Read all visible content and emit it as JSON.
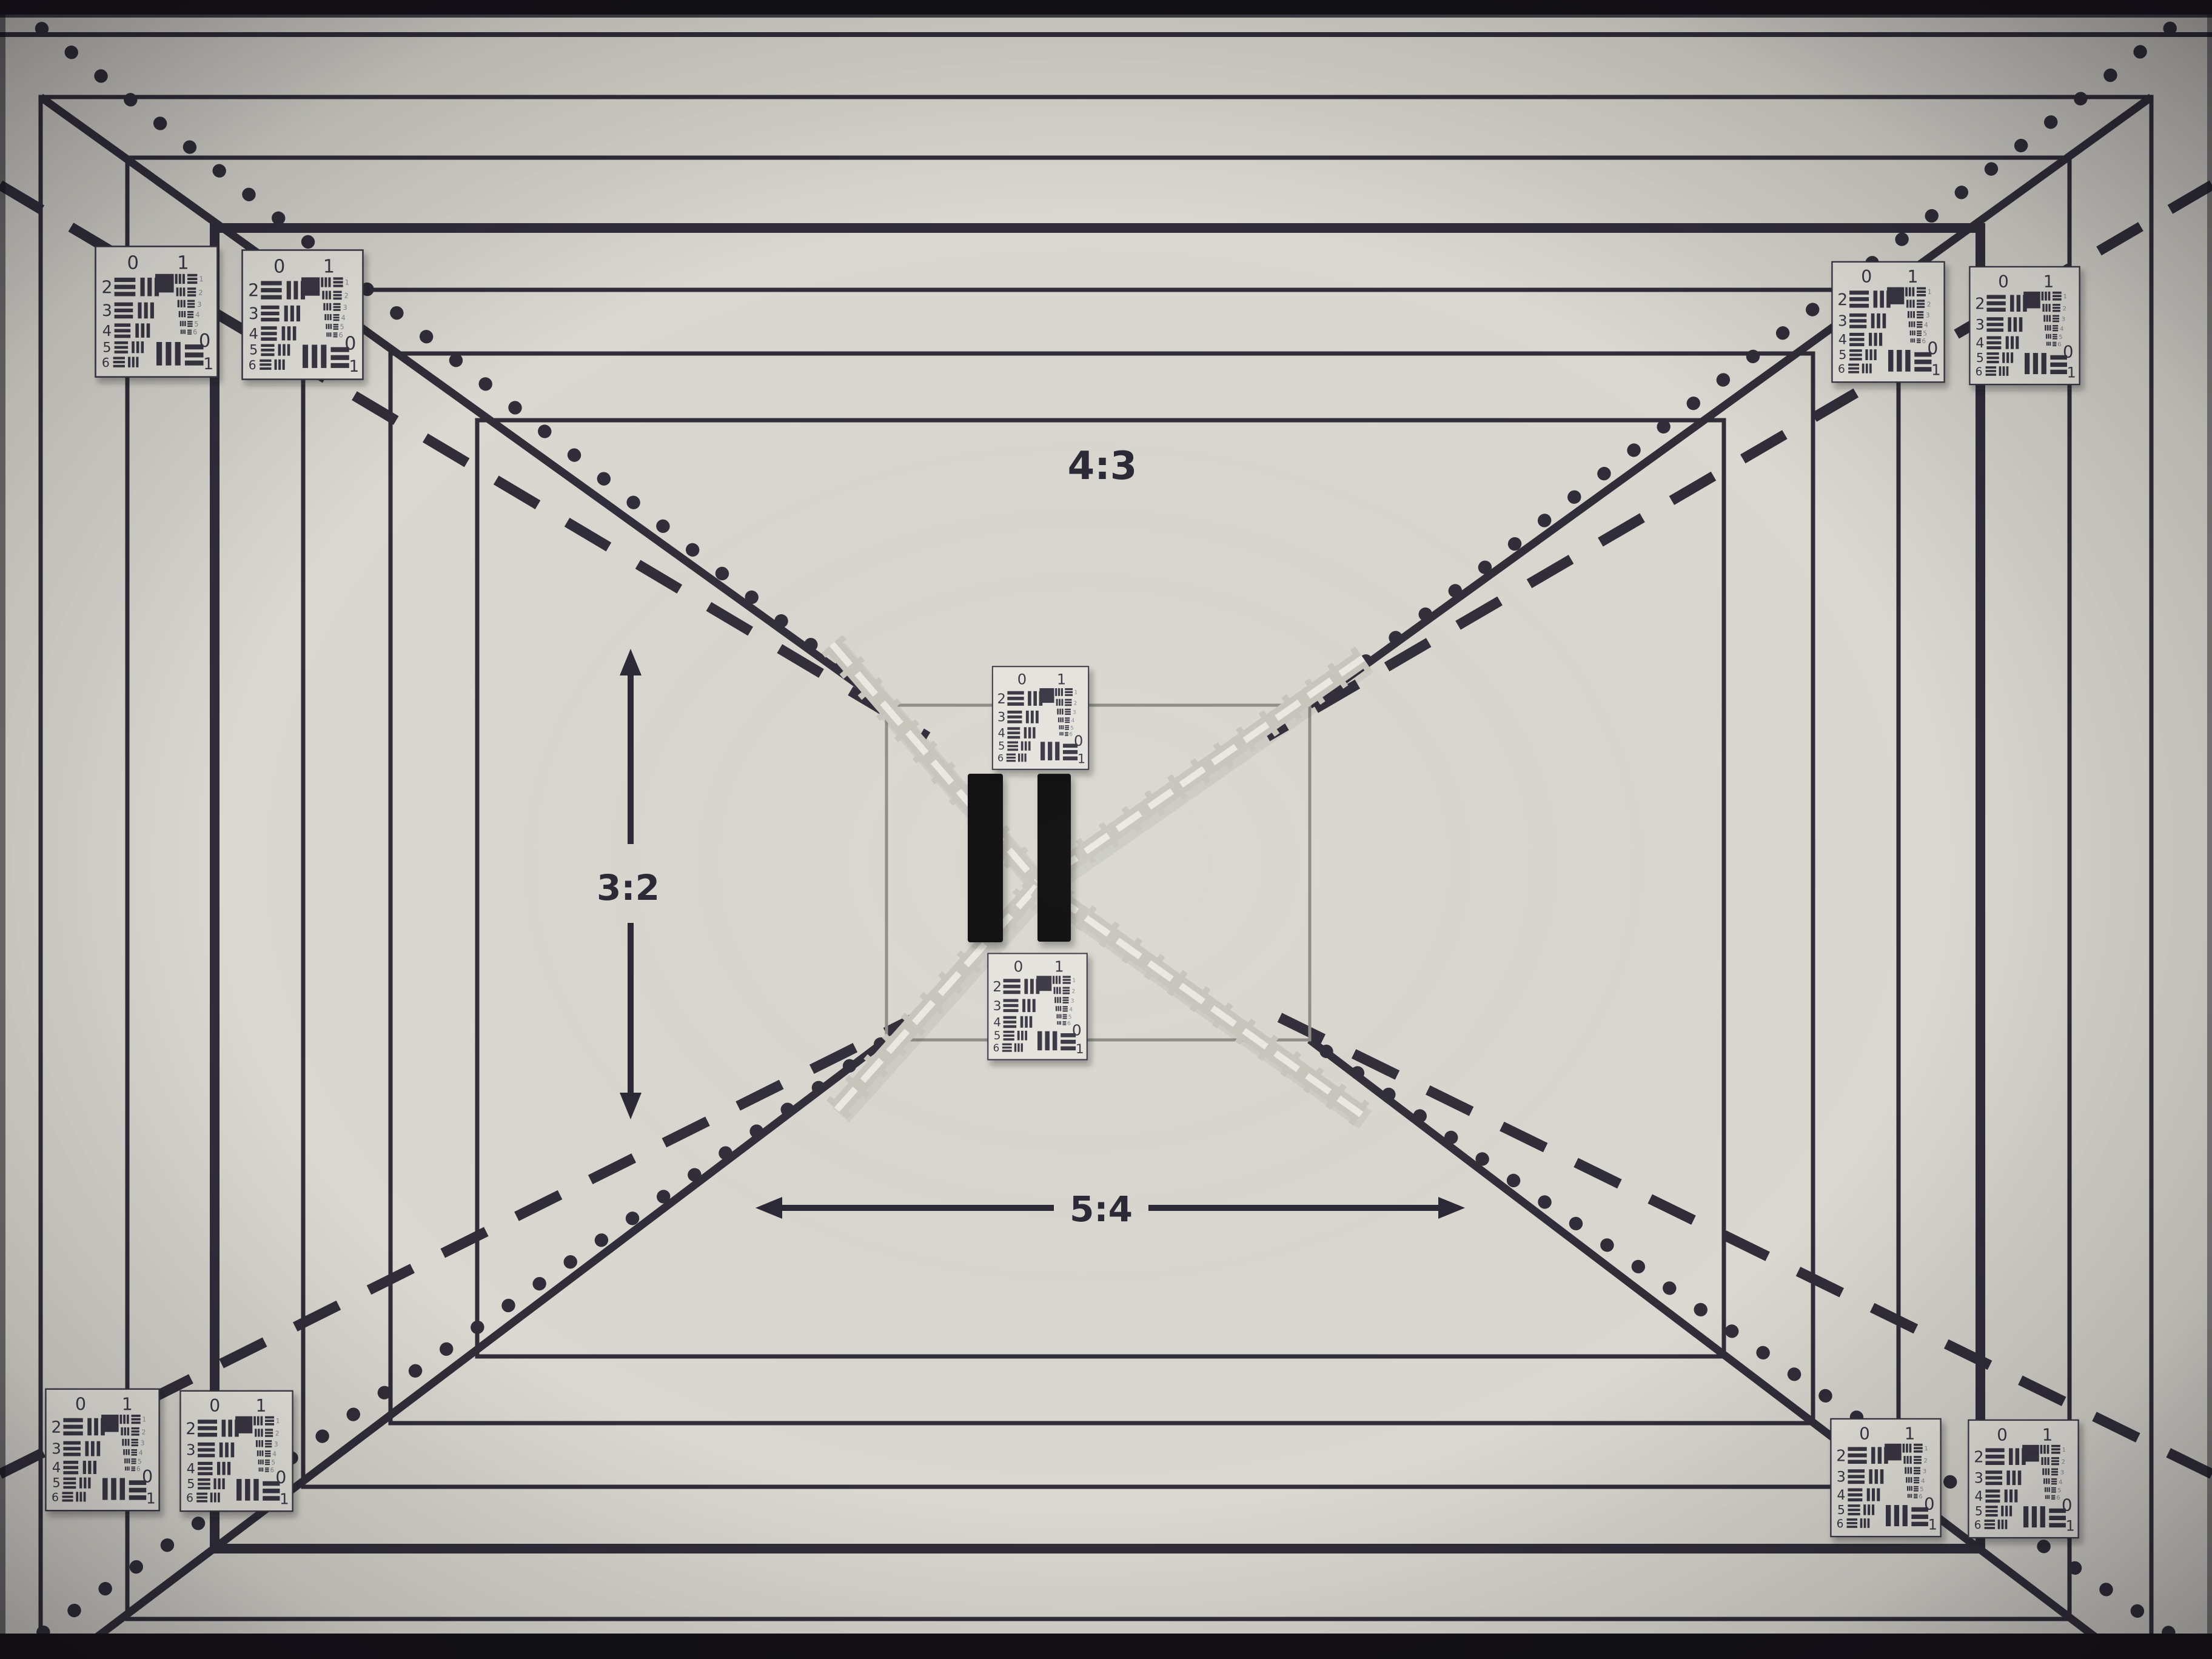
{
  "aspect_labels": {
    "top": "4:3",
    "left": "3:2",
    "bottom": "5:4"
  },
  "usaf_target": {
    "scale_top_left": "0",
    "scale_top_right": "1",
    "group_rows": [
      "2",
      "3",
      "4",
      "5",
      "6"
    ],
    "element_column": [
      "1",
      "2",
      "3",
      "4",
      "5",
      "6"
    ],
    "bottom_scale_zero": "0",
    "bottom_scale_one": "1"
  },
  "colors": {
    "bg": "#dad8d0",
    "line": "#312e3a",
    "square": "#8f8d87",
    "label": "#2b2936",
    "card-bg": "#e7e5de",
    "card-line": "#3a3745",
    "digit-faint": "#8a8890",
    "tape": "#c9c6be",
    "tape-hi": "#eceae3",
    "patch": "#0d0c10",
    "band": "#141217"
  }
}
